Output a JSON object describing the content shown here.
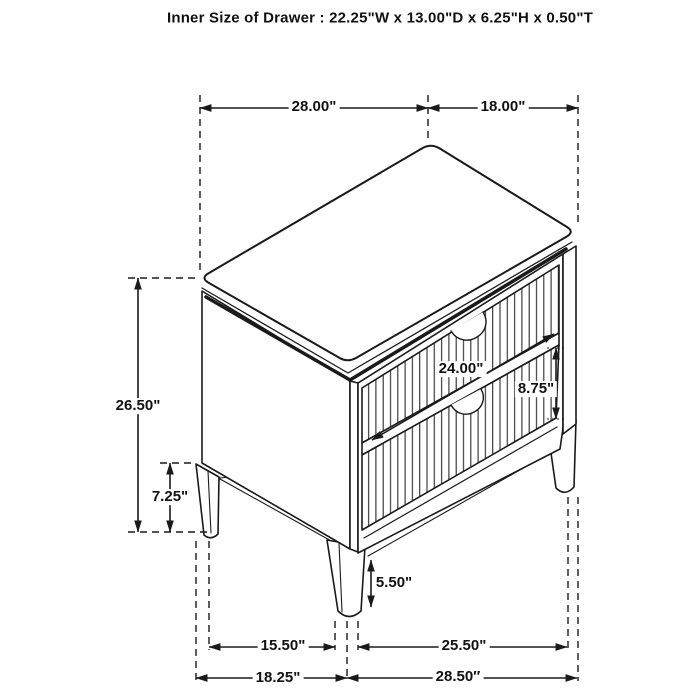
{
  "title": "Inner Size of Drawer : 22.25\"W x 13.00\"D x 6.25\"H x 0.50\"T",
  "colors": {
    "line": "#1a1a1a",
    "background": "#ffffff"
  },
  "dims": {
    "top_width": "28.00\"",
    "top_depth": "18.00\"",
    "overall_height": "26.50\"",
    "rear_leg_height": "7.25\"",
    "drawer_width": "24.00\"",
    "drawer_height": "8.75\"",
    "front_leg_height": "5.50\"",
    "front_leg_offset": "15.50\"",
    "base_span_right": "25.50\"",
    "base_span_left": "18.25\"",
    "base_width": "28.50″"
  }
}
